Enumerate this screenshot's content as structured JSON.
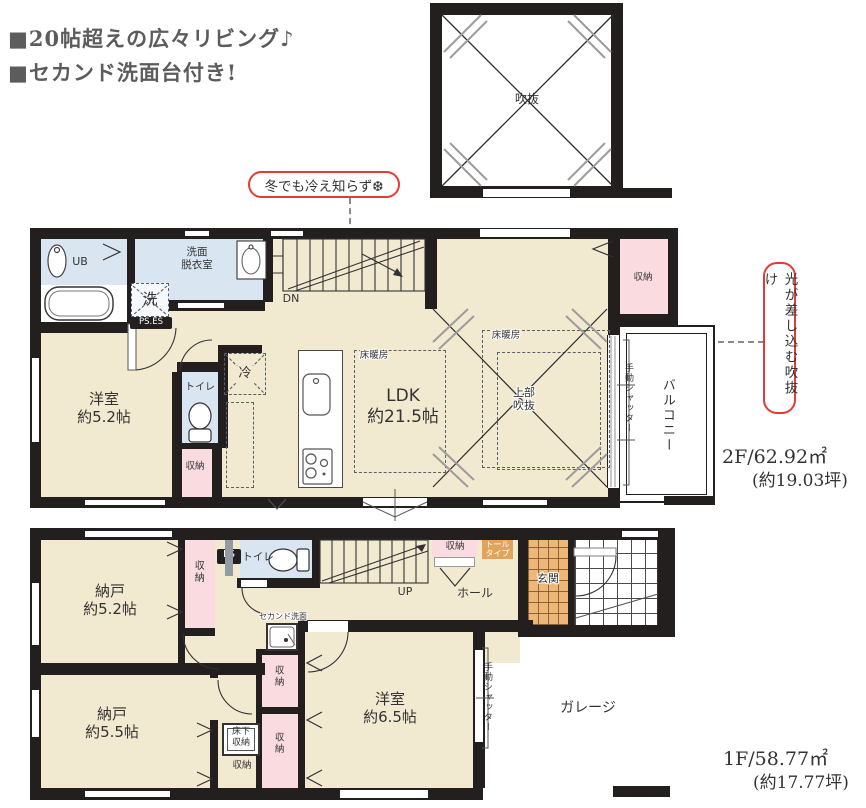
{
  "header": {
    "line1": "■20帖超えの広々リビング♪",
    "line2": "■セカンド洗面台付き!"
  },
  "callouts": {
    "winter": "冬でも冷え知らず❆",
    "light": "光が差し込む吹抜け"
  },
  "roof_void": {
    "label": "吹抜"
  },
  "floor2": {
    "area": "2F/62.92㎡",
    "tsubo": "(約19.03坪)",
    "ub": "UB",
    "washroom": "洗面\n脱衣室",
    "washer": "洗",
    "ps_es": "PS.ES",
    "dn": "DN",
    "bedroom": "洋室\n約5.2帖",
    "toilet": "トイレ",
    "closet": "収納",
    "fridge": "冷",
    "ldk": "LDK\n約21.5帖",
    "heating_left": "床暖房",
    "heating_right": "床暖房",
    "upper_void": "上部\n吹抜",
    "closet_right": "収納",
    "balcony": "バルコニー",
    "shutter": "手動シャッター"
  },
  "floor1": {
    "area": "1F/58.77㎡",
    "tsubo": "(約17.77坪)",
    "storage52": "納戸\n約5.2帖",
    "closet_left": "収納",
    "ps": "PS",
    "toilet": "トイレ",
    "second_sink": "セカンド洗面",
    "up": "UP",
    "hall": "ホール",
    "closet_hall": "収納",
    "tall_cabinet": "トール\nタイプ",
    "entrance": "玄関",
    "storage55": "納戸\n約5.5帖",
    "underfloor": "床下\n収納",
    "closet_under": "収納",
    "closet_a": "収納",
    "closet_b": "収納",
    "bedroom65": "洋室\n約6.5帖",
    "shutter": "手動シャッター",
    "garage": "ガレージ"
  },
  "colors": {
    "wall": "#221f1e",
    "room_beige": "#f2e9d1",
    "water_blue": "#d9e6f2",
    "closet_pink": "#fadce0",
    "tile_orange": "#edb778",
    "tall_orange": "#e2a45c",
    "accent_red": "#e43b32",
    "leader_gray": "#8a8a8a"
  }
}
